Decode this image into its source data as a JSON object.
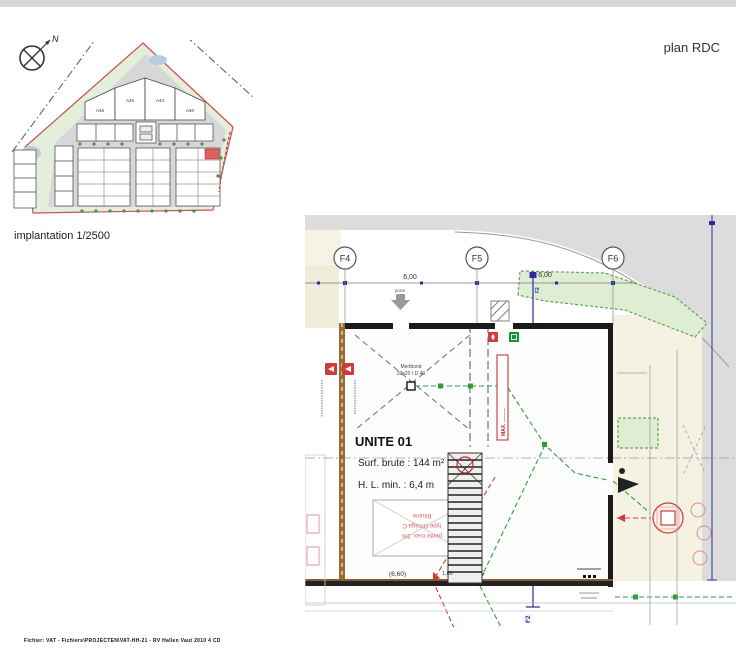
{
  "header": {
    "plan_label": "plan RDC"
  },
  "site_plan": {
    "caption": "implantation 1/2500",
    "north_label": "N",
    "block_labels": [
      "A46",
      "A45",
      "A44",
      "A40"
    ]
  },
  "floor_plan": {
    "grid_bubbles": [
      "F4",
      "F5",
      "F6"
    ],
    "axis_f2_top": "F2",
    "axis_f2_bottom": "F2",
    "dim_bay_1": "6,00",
    "dim_bay_2": "6,00",
    "dim_bottom": "(6,60)",
    "dim_stair": "1,00",
    "door_label": "porte",
    "unit_title": "UNITE 01",
    "unit_area": "Surf. brute : 144 m²",
    "unit_height": "H. L. min. :   6,4 m",
    "skylight_line1": "Mertbond",
    "skylight_line2": "20x20 / D 40",
    "max_label": "MAX. ………",
    "roof_note_line1": "Bitume",
    "roof_note_line2": "type Oméga C",
    "roof_note_line3": "pente max. 3%"
  },
  "footer": {
    "file_path": "Fichier: VAT - Fichiers\\PROJECTEN\\VAT-HH-21 - RV Hallen Vaut 2010 4 CD"
  },
  "colors": {
    "wall": "#1a1a1a",
    "hedge_fill": "#ddeed2",
    "hedge_stroke": "#63a357",
    "road_gray": "#dcdcdc",
    "beige": "#f1eedd",
    "axis_blue": "#2b2ba0",
    "safety_red": "#d23b3b",
    "path_green": "#2e9e3a"
  }
}
